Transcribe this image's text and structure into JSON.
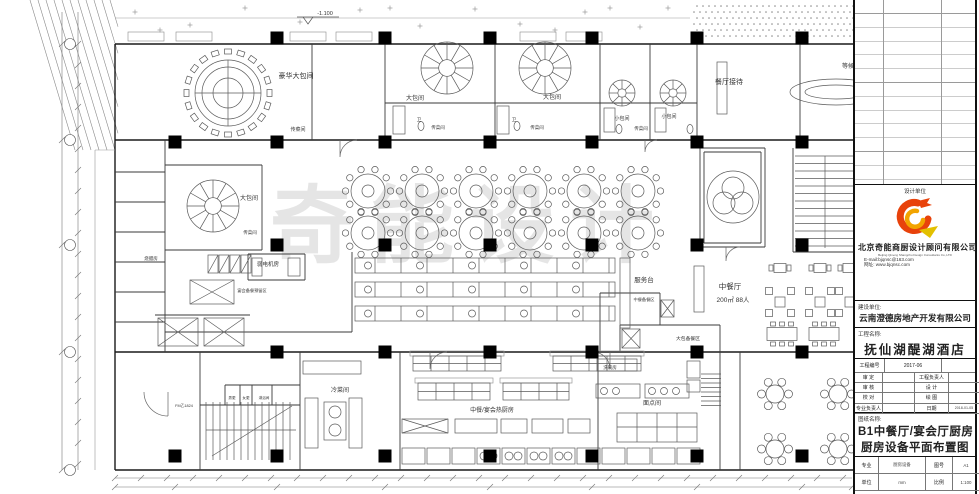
{
  "plan": {
    "watermark": "奇能设计",
    "elevation": "-1.100",
    "labels": [
      {
        "t": "豪华大包间",
        "x": 296,
        "y": 78,
        "s": 7
      },
      {
        "t": "大包间",
        "x": 415,
        "y": 100,
        "s": 6
      },
      {
        "t": "大包间",
        "x": 552,
        "y": 99,
        "s": 6
      },
      {
        "t": "小包间",
        "x": 622,
        "y": 120,
        "s": 5
      },
      {
        "t": "小包间",
        "x": 669,
        "y": 118,
        "s": 5
      },
      {
        "t": "传菜间",
        "x": 298,
        "y": 131,
        "s": 5
      },
      {
        "t": "传菜间",
        "x": 438,
        "y": 129,
        "s": 4.5
      },
      {
        "t": "传菜间",
        "x": 537,
        "y": 129,
        "s": 4.5
      },
      {
        "t": "传菜间",
        "x": 641,
        "y": 130,
        "s": 4.5
      },
      {
        "t": "卫",
        "x": 419,
        "y": 121,
        "s": 4.5
      },
      {
        "t": "卫",
        "x": 514,
        "y": 121,
        "s": 4.5
      },
      {
        "t": "餐厅接待",
        "x": 729,
        "y": 84,
        "s": 7
      },
      {
        "t": "等候区",
        "x": 851,
        "y": 68,
        "s": 6
      },
      {
        "t": "大包间",
        "x": 249,
        "y": 200,
        "s": 6
      },
      {
        "t": "传菜间",
        "x": 250,
        "y": 234,
        "s": 4.5
      },
      {
        "t": "烧腊房",
        "x": 151,
        "y": 260,
        "s": 4.5
      },
      {
        "t": "弱电机房",
        "x": 268,
        "y": 266,
        "s": 5.5
      },
      {
        "t": "宴会备餐预留区",
        "x": 252,
        "y": 292,
        "s": 4.2
      },
      {
        "t": "服务台",
        "x": 644,
        "y": 282,
        "s": 6.5
      },
      {
        "t": "中餐厅",
        "x": 730,
        "y": 289,
        "s": 7.5
      },
      {
        "t": "200㎡ 88人",
        "x": 733,
        "y": 302,
        "s": 6.5
      },
      {
        "t": "中餐备餐区",
        "x": 644,
        "y": 301,
        "s": 4.2
      },
      {
        "t": "大包备餐区",
        "x": 688,
        "y": 340,
        "s": 4.8
      },
      {
        "t": "冷菜间",
        "x": 340,
        "y": 392,
        "s": 6
      },
      {
        "t": "中餐/宴会热厨房",
        "x": 492,
        "y": 412,
        "s": 6
      },
      {
        "t": "面点间",
        "x": 652,
        "y": 405,
        "s": 6
      },
      {
        "t": "洗碗房",
        "x": 610,
        "y": 369,
        "s": 4.5
      },
      {
        "t": "男更",
        "x": 232,
        "y": 399,
        "s": 3.6
      },
      {
        "t": "女更",
        "x": 246,
        "y": 399,
        "s": 3.6
      },
      {
        "t": "淋浴间",
        "x": 264,
        "y": 399,
        "s": 3.6
      },
      {
        "t": "FM乙1824",
        "x": 184,
        "y": 407,
        "s": 3.8
      }
    ]
  },
  "title_block": {
    "design_unit_label": "设计单位",
    "company_cn": "北京奇能商厨设计顾问有限公司",
    "company_en": "Beijing Qineng Shangchu Design Consultants Co.,LTD",
    "email": "E-mail:bjqnsc@163.com",
    "website": "网址: www.bjqnsc.com",
    "client_label": "建设单位:",
    "client": "云南澄德房地产开发有限公司",
    "project_label": "工程名称:",
    "project": "抚仙湖醍湖酒店",
    "project_no_label": "工程编号",
    "project_no": "2017-06",
    "rows": [
      {
        "l": "审 定",
        "r": "工程负责人",
        "rv": ""
      },
      {
        "l": "审 核",
        "r": "设 计",
        "rv": ""
      },
      {
        "l": "校 对",
        "r": "绘 图",
        "rv": ""
      },
      {
        "l": "专业负责人",
        "r": "日期",
        "rv": "2018-01-05"
      }
    ],
    "drawing_name_label": "图纸名称:",
    "drawing_name_1": "B1中餐厅/宴会厅厨房",
    "drawing_name_2": "厨房设备平面布置图",
    "spec_label": "专业",
    "spec": "厨房设备",
    "fig_no_label": "图号",
    "fig_no": "A1",
    "unit_label": "单位",
    "unit": "mm",
    "scale_label": "比例",
    "scale": "1:100"
  }
}
